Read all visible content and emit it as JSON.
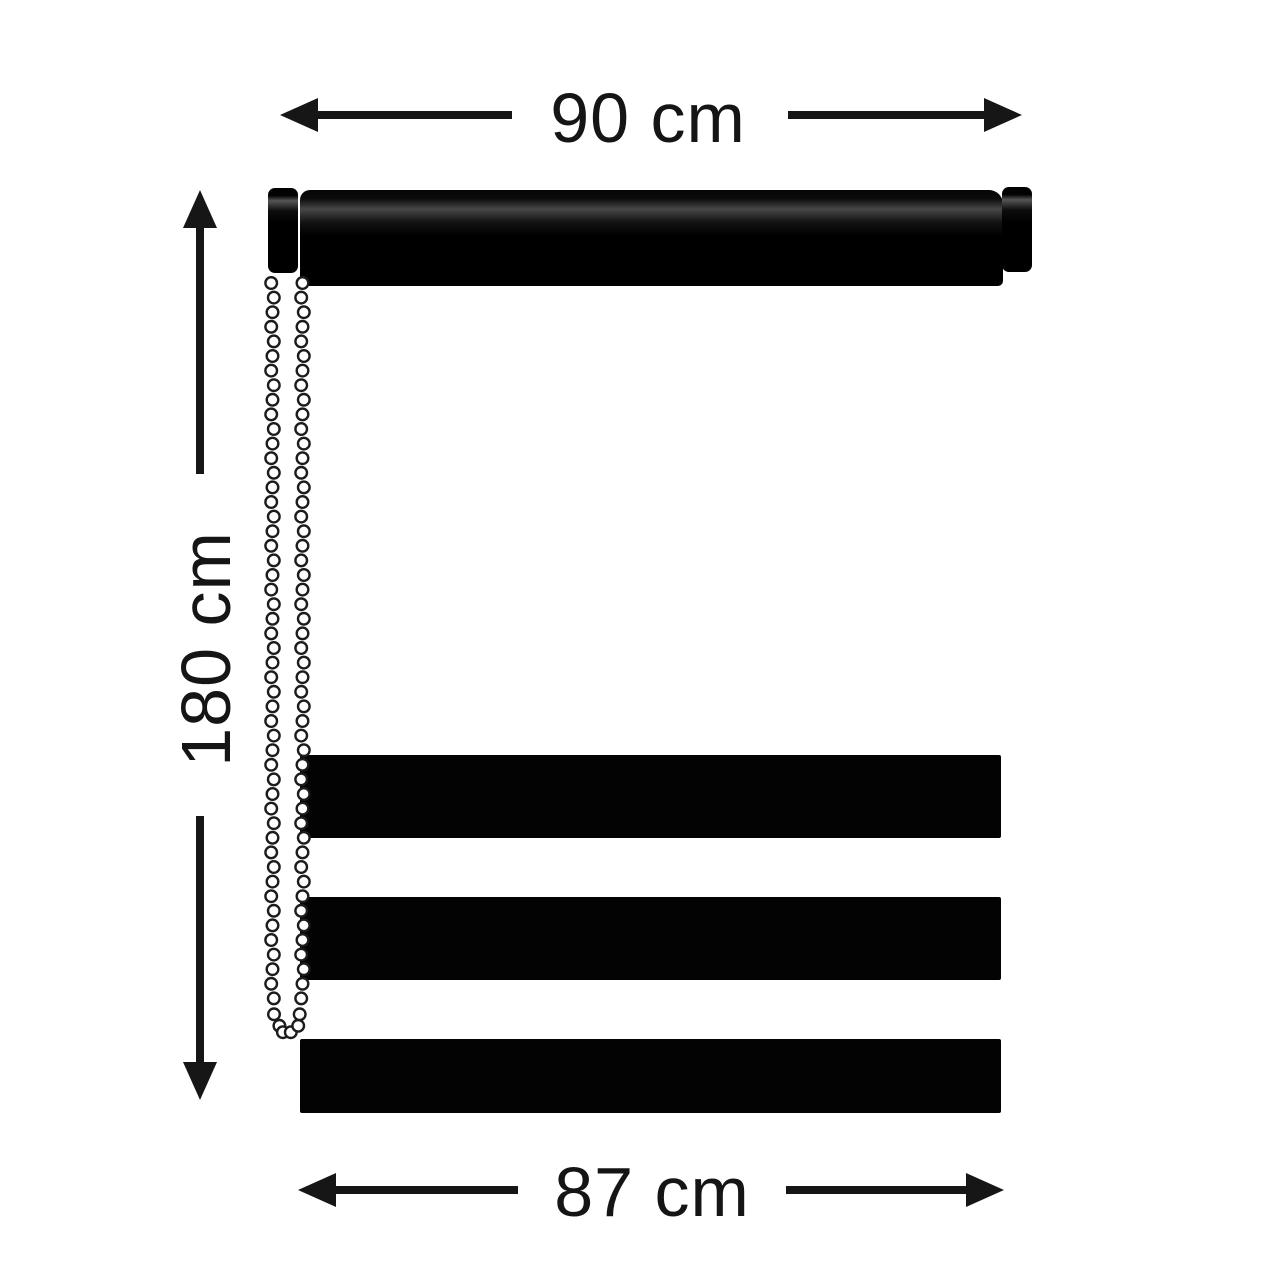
{
  "diagram": {
    "title_semantic": "roller-blind-dimension-diagram",
    "top_dimension": {
      "label": "90 cm"
    },
    "left_dimension": {
      "label": "180 cm"
    },
    "bottom_dimension": {
      "label": "87 cm"
    },
    "colors": {
      "background": "#ffffff",
      "blind": "#000000",
      "dimension_lines": "#1a1a1a",
      "chain_beads": "#ffffff",
      "chain_outline": "#1c1c1c"
    },
    "parts": {
      "stripe_count": 6,
      "chain_side": "left"
    }
  }
}
